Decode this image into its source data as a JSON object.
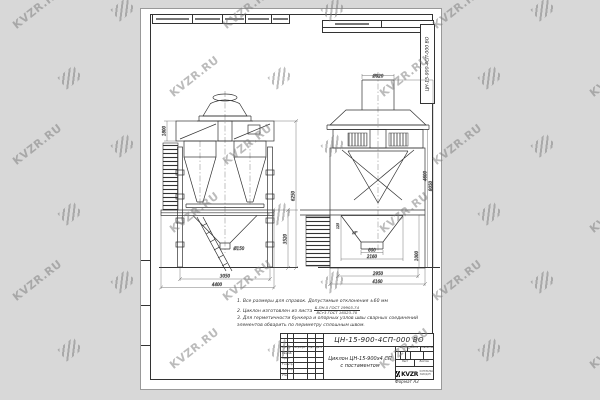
{
  "designation": "ЦН-15-900-4СП-000  ВО",
  "watermark": {
    "text": "KVZR.RU"
  },
  "colors": {
    "background": "#d8d8d8",
    "paper": "#ffffff",
    "line": "#333333",
    "watermark": "#7a7a7a"
  },
  "notes": {
    "line1": "1. Все размеры для справок. Допустимые отклонения ±60 мм",
    "line2_prefix": "2. Циклон изготовлен из листа",
    "line2_num": "Б-ПН-5 ГОСТ 19903-74",
    "line2_den": "ВСт3 ГОСТ 16523-70",
    "line3": "3. Для герметичности бункера и опорных узлов швы сварных соединений элементов обварить по периметру сплошным швом."
  },
  "title_block": {
    "name_line1": "Циклон ЦН-15-900х4 СП",
    "name_line2": "с постаментом",
    "header_cols": [
      "Изм",
      "Лист",
      "№ докум.",
      "Подп.",
      "Дата"
    ],
    "sign_rows": [
      "Разраб.",
      "Пров.",
      "Т.контр.",
      "Н.контр.",
      "Утв."
    ],
    "lit_label": "Лит.",
    "mass_label": "Масса",
    "scale_label": "Масштаб",
    "sheet_label": "Лист",
    "sheets_label": "Листов",
    "logo_text": "KVZR",
    "logo_sub1": "КОТЕЛЬНЫЙ",
    "logo_sub2": "ЗАВОД.РУ",
    "format_label": "Формат  А3"
  },
  "dims": {
    "front_box_height": "1800",
    "front_bottom_inner": "3050",
    "front_bottom_outer": "4400",
    "front_right_lower": "3520",
    "front_right_total": "6250",
    "front_outlet": "Ø150",
    "side_top_stub": "Ø920",
    "side_outlet": "600",
    "side_hopper": "2160",
    "side_bottom_inner": "2950",
    "side_bottom_outer": "4160",
    "side_right_mid": "4600",
    "side_right_total": "8050",
    "side_right_lower": "1000",
    "side_hopper_small": "125",
    "side_hopper_angle": "15°"
  }
}
